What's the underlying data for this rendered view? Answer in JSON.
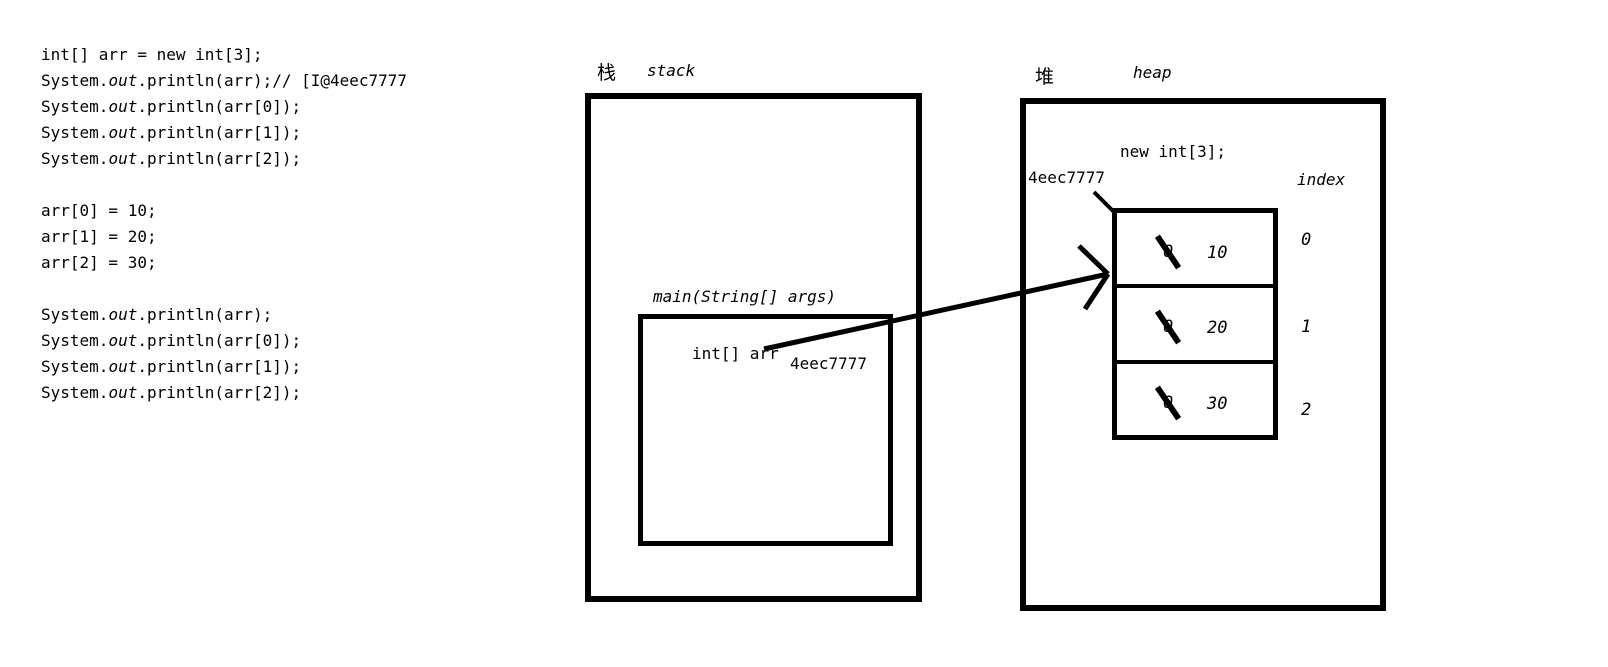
{
  "code": {
    "lines": [
      [
        {
          "t": "int[] arr = new int[3];",
          "i": false
        }
      ],
      [
        {
          "t": "System.",
          "i": false
        },
        {
          "t": "out",
          "i": true
        },
        {
          "t": ".println(arr);// [I@4eec7777",
          "i": false
        }
      ],
      [
        {
          "t": "System.",
          "i": false
        },
        {
          "t": "out",
          "i": true
        },
        {
          "t": ".println(arr[0]);",
          "i": false
        }
      ],
      [
        {
          "t": "System.",
          "i": false
        },
        {
          "t": "out",
          "i": true
        },
        {
          "t": ".println(arr[1]);",
          "i": false
        }
      ],
      [
        {
          "t": "System.",
          "i": false
        },
        {
          "t": "out",
          "i": true
        },
        {
          "t": ".println(arr[2]);",
          "i": false
        }
      ],
      [],
      [
        {
          "t": "arr[0] = 10;",
          "i": false
        }
      ],
      [
        {
          "t": "arr[1] = 20;",
          "i": false
        }
      ],
      [
        {
          "t": "arr[2] = 30;",
          "i": false
        }
      ],
      [],
      [
        {
          "t": "System.",
          "i": false
        },
        {
          "t": "out",
          "i": true
        },
        {
          "t": ".println(arr);",
          "i": false
        }
      ],
      [
        {
          "t": "System.",
          "i": false
        },
        {
          "t": "out",
          "i": true
        },
        {
          "t": ".println(arr[0]);",
          "i": false
        }
      ],
      [
        {
          "t": "System.",
          "i": false
        },
        {
          "t": "out",
          "i": true
        },
        {
          "t": ".println(arr[1]);",
          "i": false
        }
      ],
      [
        {
          "t": "System.",
          "i": false
        },
        {
          "t": "out",
          "i": true
        },
        {
          "t": ".println(arr[2]);",
          "i": false
        }
      ]
    ]
  },
  "stack": {
    "label_cn": "栈",
    "label_en": "stack",
    "frame_label": "main(String[] args)",
    "var_label": "int[] arr",
    "var_value": "4eec7777"
  },
  "heap": {
    "label_cn": "堆",
    "label_en": "heap",
    "alloc_label": "new int[3];",
    "address": "4eec7777",
    "index_header": "index",
    "array": {
      "cells": [
        {
          "old": "0",
          "value": "10",
          "index": "0"
        },
        {
          "old": "0",
          "value": "20",
          "index": "1"
        },
        {
          "old": "0",
          "value": "30",
          "index": "2"
        }
      ]
    }
  },
  "colors": {
    "ink": "#000000",
    "background": "#ffffff"
  }
}
